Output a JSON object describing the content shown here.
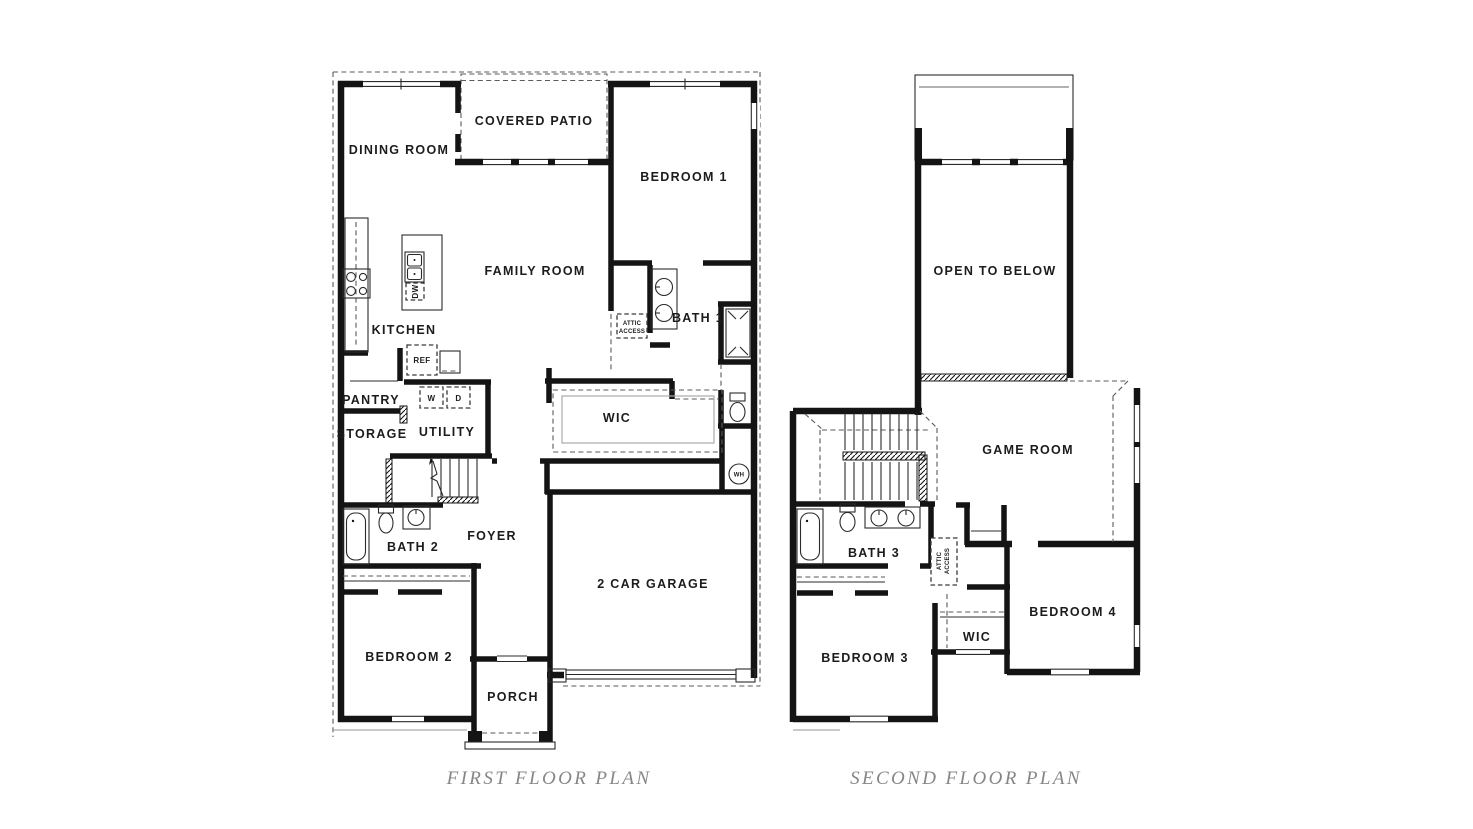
{
  "ff": {
    "title": "FIRST FLOOR PLAN",
    "rooms": {
      "dining": "DINING ROOM",
      "patio": "COVERED PATIO",
      "bed1": "BEDROOM 1",
      "family": "FAMILY ROOM",
      "kitchen": "KITCHEN",
      "bath1": "BATH 1",
      "pantry": "PANTRY",
      "storage": "STORAGE",
      "utility": "UTILITY",
      "wic": "WIC",
      "foyer": "FOYER",
      "bath2": "BATH 2",
      "bed2": "BEDROOM 2",
      "porch": "PORCH",
      "garage": "2 CAR GARAGE"
    },
    "fixtures": {
      "ref": "REF",
      "washer": "W",
      "dryer": "D",
      "dishwasher": "DW",
      "water_heater": "WH",
      "attic1": "ATTIC",
      "attic2": "ACCESS"
    }
  },
  "sf": {
    "title": "SECOND FLOOR PLAN",
    "rooms": {
      "open": "OPEN TO BELOW",
      "game": "GAME ROOM",
      "bath3": "BATH 3",
      "bed3": "BEDROOM 3",
      "wic": "WIC",
      "bed4": "BEDROOM 4"
    },
    "fixtures": {
      "attic1": "ATTIC",
      "attic2": "ACCESS"
    }
  },
  "style": {
    "wall_color": "#141414",
    "caption_color": "#868686",
    "background": "#ffffff"
  }
}
